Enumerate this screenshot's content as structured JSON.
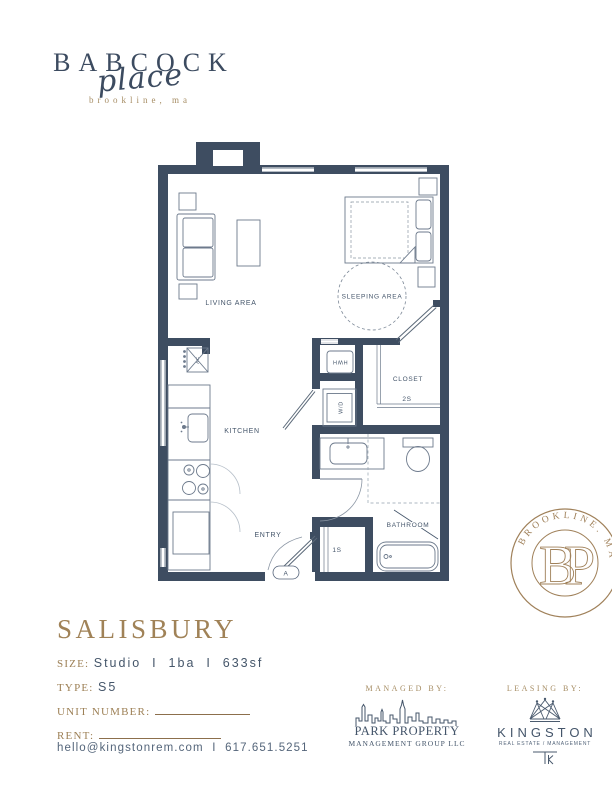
{
  "logo": {
    "name": "BABCOCK",
    "script": "place",
    "location": "brookline, ma"
  },
  "floorplan": {
    "rooms": {
      "living_area": "LIVING AREA",
      "sleeping_area": "SLEEPING AREA",
      "kitchen": "KITCHEN",
      "entry": "ENTRY",
      "closet": "CLOSET",
      "bathroom": "BATHROOM"
    },
    "tags": {
      "closet_shelf": "2S",
      "entry_closet_shelf": "1S",
      "entry_door": "A"
    },
    "appliances": {
      "hwh": "HWH",
      "washer_dryer": "W/D",
      "dishwasher": "DW",
      "refrigerator": "REF.",
      "ac": "AC"
    }
  },
  "stamp": {
    "arc_text": "BROOKLINE. MA",
    "monogram_b": "B",
    "monogram_p": "P"
  },
  "unit": {
    "name": "SALISBURY",
    "size_label": "SIZE:",
    "size_value": "Studio  I  1ba  I  633sf",
    "type_label": "TYPE:",
    "type_value": "S5",
    "unit_number_label": "UNIT NUMBER:",
    "rent_label": "RENT:"
  },
  "contact": {
    "email": "hello@kingstonrem.com",
    "separator": "I",
    "phone": "617.651.5251"
  },
  "managed_by": {
    "heading": "MANAGED BY:",
    "logo_line1": "PARK PROPERTY",
    "logo_line2": "MANAGEMENT GROUP LLC"
  },
  "leasing_by": {
    "heading": "LEASING BY:",
    "brand": "KINGSTON",
    "brand_subtitle": "REAL ESTATE / MANAGEMENT"
  },
  "colors": {
    "wall": "#3e4d61",
    "gold": "#a3845c",
    "slate_text": "#45566a"
  }
}
